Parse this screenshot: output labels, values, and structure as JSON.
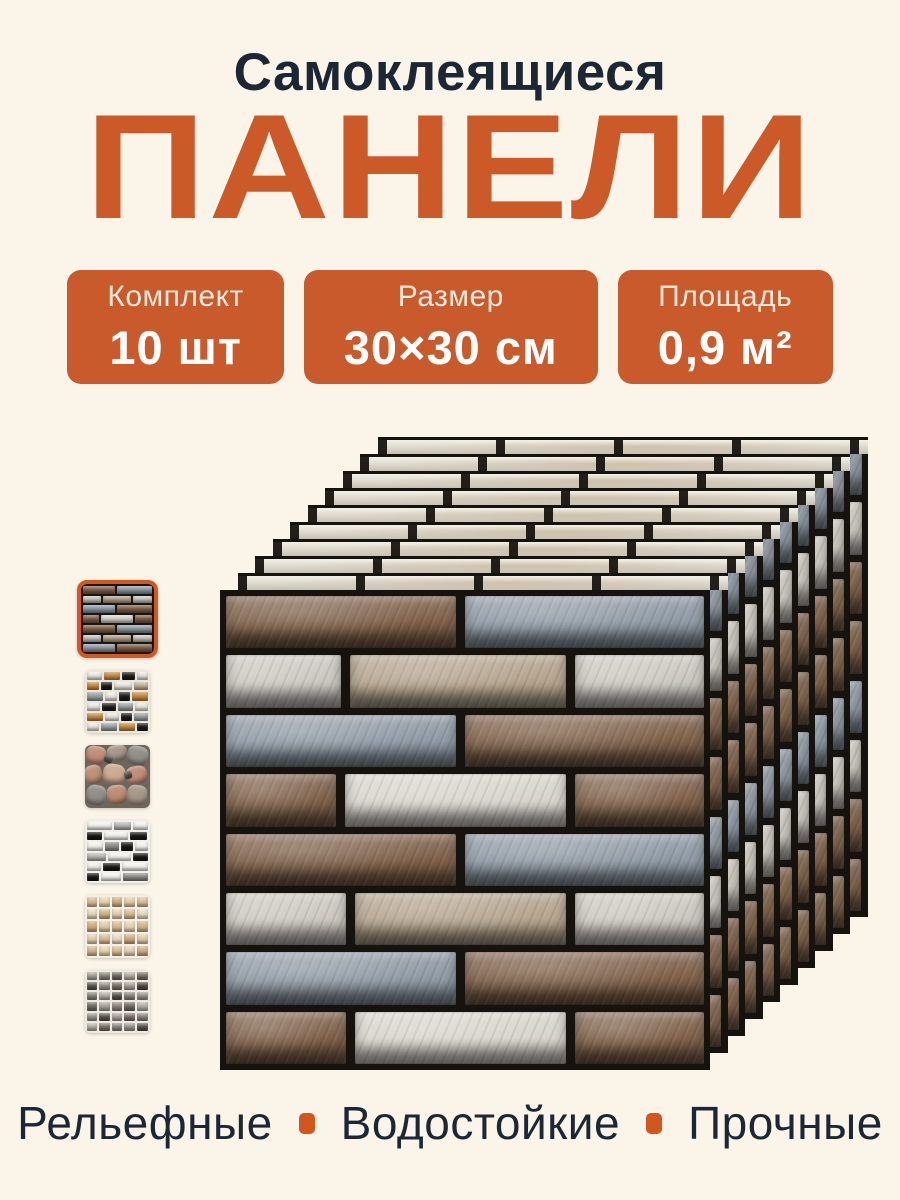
{
  "page": {
    "background": "#FAF4E9",
    "accent_orange": "#CC5A28",
    "badge_orange": "#C85A2B",
    "text_dark": "#1C2736"
  },
  "header": {
    "subtitle": "Самоклеящиеся",
    "title": "ПАНЕЛИ"
  },
  "badges": [
    {
      "label": "Комплект",
      "value": "10 шт"
    },
    {
      "label": "Размер",
      "value": "30×30 см"
    },
    {
      "label": "Площадь",
      "value": "0,9 м²"
    }
  ],
  "features": [
    "Рельефные",
    "Водостойкие",
    "Прочные"
  ],
  "product": {
    "stack": {
      "count": 10,
      "offset_x": 17.5,
      "offset_y": 17,
      "panel_width": 490,
      "panel_height": 480
    },
    "palette": {
      "grout": "#16120E",
      "brown": "#7E6049",
      "blue": "#8E99A4",
      "light": "#CBC7BF",
      "beige": "#B4A38D",
      "white": "#D8D4CC"
    },
    "pattern_rows": [
      [
        {
          "c": "brown",
          "w": 49
        },
        {
          "c": "blue",
          "w": 51
        }
      ],
      [
        {
          "c": "light",
          "w": 25
        },
        {
          "c": "beige",
          "w": 47
        },
        {
          "c": "light",
          "w": 28
        }
      ],
      [
        {
          "c": "blue",
          "w": 49
        },
        {
          "c": "brown",
          "w": 51
        }
      ],
      [
        {
          "c": "brown",
          "w": 24
        },
        {
          "c": "white",
          "w": 48
        },
        {
          "c": "brown",
          "w": 28
        }
      ],
      [
        {
          "c": "brown",
          "w": 49
        },
        {
          "c": "blue",
          "w": 51
        }
      ],
      [
        {
          "c": "light",
          "w": 26
        },
        {
          "c": "beige",
          "w": 46
        },
        {
          "c": "light",
          "w": 28
        }
      ],
      [
        {
          "c": "blue",
          "w": 49
        },
        {
          "c": "brown",
          "w": 51
        }
      ],
      [
        {
          "c": "brown",
          "w": 26
        },
        {
          "c": "white",
          "w": 46
        },
        {
          "c": "brown",
          "w": 28
        }
      ]
    ],
    "thumbnails": [
      {
        "name": "brick-brown-gray",
        "selected": true,
        "type": "brick",
        "grout": "#1A1613",
        "rows": [
          [
            {
              "c": "#7E6049",
              "w": 49
            },
            {
              "c": "#8E99A4",
              "w": 51
            }
          ],
          [
            {
              "c": "#CBC7BF",
              "w": 28
            },
            {
              "c": "#B4A38D",
              "w": 44
            },
            {
              "c": "#CBC7BF",
              "w": 28
            }
          ],
          [
            {
              "c": "#8E99A4",
              "w": 49
            },
            {
              "c": "#7E6049",
              "w": 51
            }
          ],
          [
            {
              "c": "#7E6049",
              "w": 25
            },
            {
              "c": "#D8D4CC",
              "w": 50
            },
            {
              "c": "#7E6049",
              "w": 25
            }
          ],
          [
            {
              "c": "#7E6049",
              "w": 49
            },
            {
              "c": "#8E99A4",
              "w": 51
            }
          ],
          [
            {
              "c": "#CBC7BF",
              "w": 28
            },
            {
              "c": "#B4A38D",
              "w": 44
            },
            {
              "c": "#CBC7BF",
              "w": 28
            }
          ],
          [
            {
              "c": "#8E99A4",
              "w": 49
            },
            {
              "c": "#7E6049",
              "w": 51
            }
          ]
        ]
      },
      {
        "name": "brick-orange-black-marble",
        "selected": false,
        "type": "brick",
        "grout": "#ECE7DD",
        "rows": [
          [
            {
              "c": "#ECE9E2",
              "w": 28
            },
            {
              "c": "#C98B3F",
              "w": 30
            },
            {
              "c": "#1D1C1A",
              "w": 22
            },
            {
              "c": "#ECE9E2",
              "w": 20
            }
          ],
          [
            {
              "c": "#C98B3F",
              "w": 22
            },
            {
              "c": "#1D1C1A",
              "w": 20
            },
            {
              "c": "#ECE9E2",
              "w": 33
            },
            {
              "c": "#C9B295",
              "w": 25
            }
          ],
          [
            {
              "c": "#9AA0A0",
              "w": 30
            },
            {
              "c": "#ECE9E2",
              "w": 22
            },
            {
              "c": "#1D1C1A",
              "w": 20
            },
            {
              "c": "#C98B3F",
              "w": 28
            }
          ],
          [
            {
              "c": "#ECE9E2",
              "w": 25
            },
            {
              "c": "#1D1C1A",
              "w": 25
            },
            {
              "c": "#9AA0A0",
              "w": 28
            },
            {
              "c": "#ECE9E2",
              "w": 22
            }
          ],
          [
            {
              "c": "#C98B3F",
              "w": 30
            },
            {
              "c": "#ECE9E2",
              "w": 25
            },
            {
              "c": "#1D1C1A",
              "w": 20
            },
            {
              "c": "#9AA0A0",
              "w": 25
            }
          ],
          [
            {
              "c": "#ECE9E2",
              "w": 22
            },
            {
              "c": "#9AA0A0",
              "w": 30
            },
            {
              "c": "#C98B3F",
              "w": 28
            },
            {
              "c": "#1D1C1A",
              "w": 20
            }
          ]
        ]
      },
      {
        "name": "flagstone",
        "selected": false,
        "type": "flagstone",
        "bg": "#6E665D",
        "stones": [
          {
            "x": 2,
            "y": 2,
            "w": 30,
            "h": 28,
            "r": 10,
            "c": "#C08A74"
          },
          {
            "x": 34,
            "y": 0,
            "w": 30,
            "h": 26,
            "r": -8,
            "c": "#A39486"
          },
          {
            "x": 66,
            "y": 2,
            "w": 32,
            "h": 30,
            "r": 14,
            "c": "#8F8B85"
          },
          {
            "x": 0,
            "y": 32,
            "w": 26,
            "h": 30,
            "r": -12,
            "c": "#B98F70"
          },
          {
            "x": 28,
            "y": 30,
            "w": 34,
            "h": 32,
            "r": 8,
            "c": "#C9A98C"
          },
          {
            "x": 64,
            "y": 34,
            "w": 32,
            "h": 28,
            "r": -10,
            "c": "#C08A74"
          },
          {
            "x": 2,
            "y": 64,
            "w": 30,
            "h": 32,
            "r": 12,
            "c": "#8F8B85"
          },
          {
            "x": 34,
            "y": 64,
            "w": 30,
            "h": 30,
            "r": -6,
            "c": "#BB8A6E"
          },
          {
            "x": 66,
            "y": 64,
            "w": 30,
            "h": 32,
            "r": 6,
            "c": "#A39486"
          },
          {
            "x": 30,
            "y": 16,
            "w": 14,
            "h": 12,
            "r": 20,
            "c": "#5A544C"
          },
          {
            "x": 60,
            "y": 42,
            "w": 12,
            "h": 12,
            "r": -16,
            "c": "#5A544C"
          }
        ]
      },
      {
        "name": "marble-brick-black-white",
        "selected": false,
        "type": "brick",
        "grout": "#F1EFE9",
        "rows": [
          [
            {
              "c": "#F4F2EC",
              "w": 45
            },
            {
              "c": "#B9B7B1",
              "w": 30
            },
            {
              "c": "#F4F2EC",
              "w": 25
            }
          ],
          [
            {
              "c": "#191816",
              "w": 28
            },
            {
              "c": "#F4F2EC",
              "w": 42
            },
            {
              "c": "#191816",
              "w": 30
            }
          ],
          [
            {
              "c": "#F4F2EC",
              "w": 30
            },
            {
              "c": "#8F8D88",
              "w": 25
            },
            {
              "c": "#191816",
              "w": 22
            },
            {
              "c": "#F4F2EC",
              "w": 23
            }
          ],
          [
            {
              "c": "#B9B7B1",
              "w": 35
            },
            {
              "c": "#F4F2EC",
              "w": 40
            },
            {
              "c": "#191816",
              "w": 25
            }
          ],
          [
            {
              "c": "#F4F2EC",
              "w": 25
            },
            {
              "c": "#191816",
              "w": 30
            },
            {
              "c": "#F4F2EC",
              "w": 45
            }
          ],
          [
            {
              "c": "#191816",
              "w": 22
            },
            {
              "c": "#F4F2EC",
              "w": 35
            },
            {
              "c": "#8F8D88",
              "w": 43
            }
          ]
        ]
      },
      {
        "name": "mosaic-beige",
        "selected": false,
        "type": "mosaic",
        "grout": "#F3EFE6",
        "grid": [
          [
            "#D8BD92",
            "#E7D4AE",
            "#CFAE7F",
            "#E2CDA4",
            "#D9C098"
          ],
          [
            "#E8D8B6",
            "#D3B68A",
            "#E5D2AD",
            "#D8BD92",
            "#E9DCC0"
          ],
          [
            "#CFAE7F",
            "#E2CDA4",
            "#D8BD92",
            "#E7D4AE",
            "#D3B68A"
          ],
          [
            "#E5D2AD",
            "#D8BD92",
            "#E9DCC0",
            "#CFAE7F",
            "#E2CDA4"
          ],
          [
            "#D3B68A",
            "#E7D4AE",
            "#D8BD92",
            "#E5D2AD",
            "#CFAE7F"
          ]
        ]
      },
      {
        "name": "mosaic-gray-brown",
        "selected": false,
        "type": "mosaic",
        "grout": "#EEE9E0",
        "grid": [
          [
            "#A9A39A",
            "#8B857B",
            "#6E685F",
            "#B5AFA6",
            "#7B7066"
          ],
          [
            "#58534C",
            "#9B958C",
            "#7B7066",
            "#A9A39A",
            "#4E4943"
          ],
          [
            "#8B857B",
            "#B5AFA6",
            "#58534C",
            "#8B857B",
            "#9B958C"
          ],
          [
            "#6E685F",
            "#A9A39A",
            "#8B857B",
            "#6E685F",
            "#B5AFA6"
          ],
          [
            "#9B958C",
            "#58534C",
            "#A9A39A",
            "#7B7066",
            "#8B857B"
          ],
          [
            "#B5AFA6",
            "#7B7066",
            "#8B857B",
            "#9B958C",
            "#58534C"
          ]
        ]
      }
    ]
  }
}
